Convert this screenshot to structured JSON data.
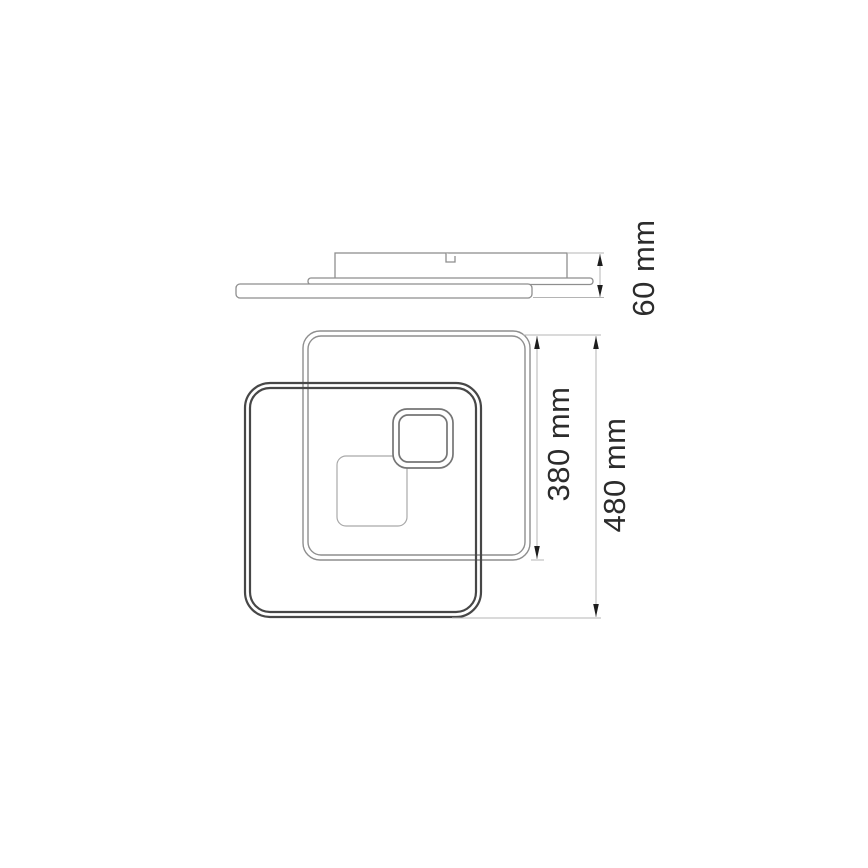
{
  "diagram": {
    "kind": "technical-dimension-drawing",
    "dimensions": {
      "depth": {
        "label": "60 mm",
        "value": 60,
        "unit": "mm"
      },
      "frame": {
        "label": "380 mm",
        "value": 380,
        "unit": "mm"
      },
      "overall": {
        "label": "480 mm",
        "value": 480,
        "unit": "mm"
      }
    },
    "colors": {
      "background": "#ffffff",
      "line_mid": "#8e8e8e",
      "line_dark": "#474747",
      "line_ring": "#757575",
      "line_light": "#a9a9a9",
      "line_dim": "#b4b4b4",
      "arrow": "#1e1e1e",
      "text": "#2c2c2c"
    }
  }
}
